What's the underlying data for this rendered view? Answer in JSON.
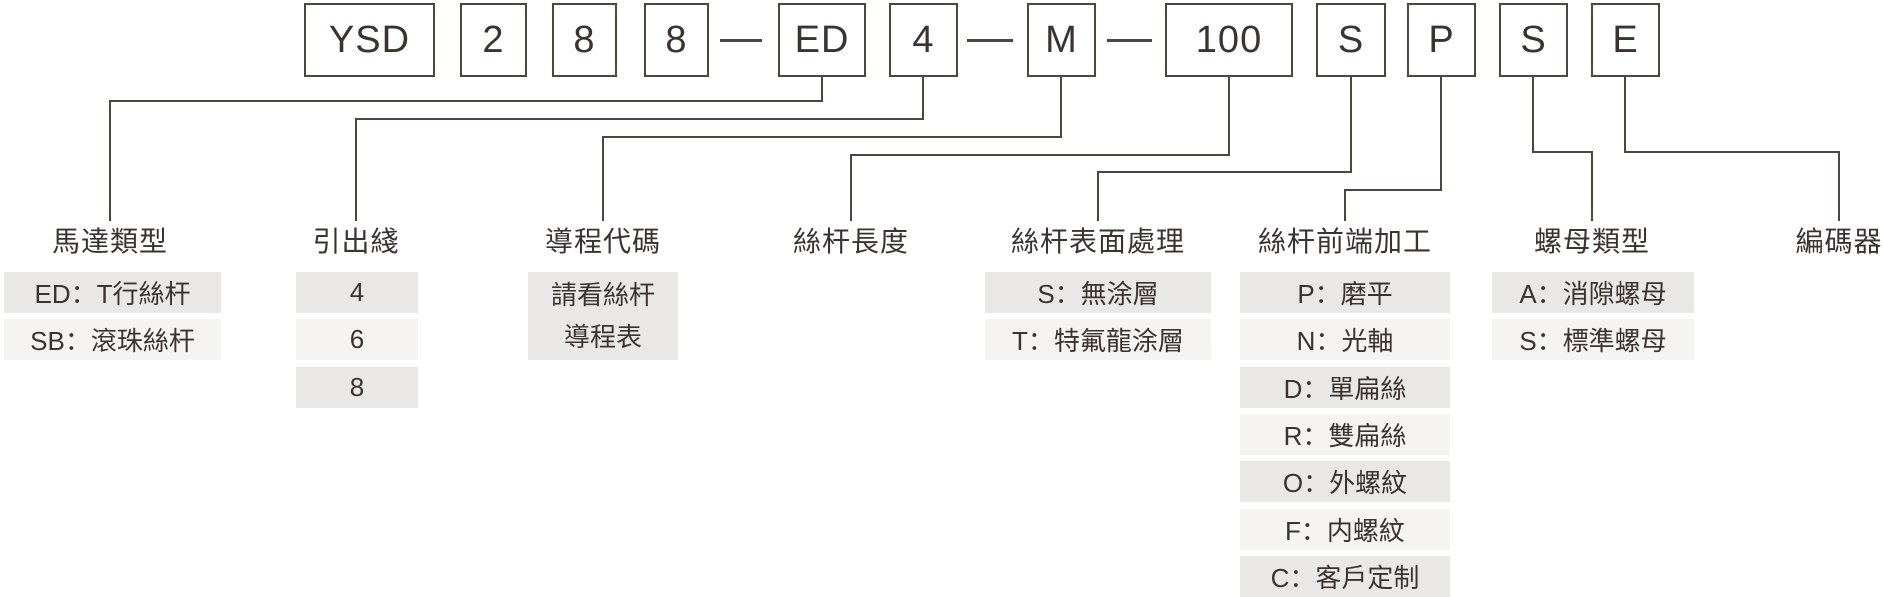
{
  "diagram": {
    "kind": "product-ordering-code-breakdown",
    "example_code": "YSD288-ED4-M-100SPSE"
  },
  "code_boxes": [
    {
      "text": "YSD",
      "x": 304,
      "w": 131
    },
    {
      "text": "2",
      "x": 460,
      "w": 67
    },
    {
      "text": "8",
      "x": 552,
      "w": 65
    },
    {
      "text": "8",
      "x": 644,
      "w": 65
    },
    {
      "text": "ED",
      "x": 778,
      "w": 88
    },
    {
      "text": "4",
      "x": 889,
      "w": 69
    },
    {
      "text": "M",
      "x": 1027,
      "w": 69
    },
    {
      "text": "100",
      "x": 1165,
      "w": 128
    },
    {
      "text": "S",
      "x": 1316,
      "w": 70
    },
    {
      "text": "P",
      "x": 1407,
      "w": 69
    },
    {
      "text": "S",
      "x": 1499,
      "w": 69
    },
    {
      "text": "E",
      "x": 1591,
      "w": 69
    }
  ],
  "dash_separators": [
    {
      "x": 720,
      "w": 42
    },
    {
      "x": 967,
      "w": 46
    },
    {
      "x": 1107,
      "w": 45
    }
  ],
  "columns": [
    {
      "label": "馬達類型",
      "cx": 110,
      "box_cx": 822,
      "elbow_y": 100,
      "items_x": 4,
      "items_w": 217,
      "items": [
        "ED：T行絲杆",
        "SB：滾珠絲杆"
      ]
    },
    {
      "label": "引出綫",
      "cx": 356,
      "box_cx": 923,
      "elbow_y": 118,
      "items_x": 296,
      "items_w": 122,
      "items": [
        "4",
        "6",
        "8"
      ]
    },
    {
      "label": "導程代碼",
      "cx": 603,
      "box_cx": 1061,
      "elbow_y": 136,
      "items_x": 528,
      "items_w": 150,
      "items": [],
      "note_lines": [
        "請看絲杆",
        "導程表"
      ]
    },
    {
      "label": "絲杆長度",
      "cx": 851,
      "box_cx": 1229,
      "elbow_y": 154,
      "items": []
    },
    {
      "label": "絲杆表面處理",
      "cx": 1098,
      "box_cx": 1351,
      "elbow_y": 171,
      "items_x": 985,
      "items_w": 226,
      "items": [
        "S：無涂層",
        "T：特氟龍涂層"
      ]
    },
    {
      "label": "絲杆前端加工",
      "cx": 1345,
      "box_cx": 1441,
      "elbow_y": 189,
      "items_x": 1240,
      "items_w": 210,
      "items": [
        "P：磨平",
        "N：光軸",
        "D：單扁絲",
        "R：雙扁絲",
        "O：外螺紋",
        "F：内螺紋",
        "C：客戶定制"
      ]
    },
    {
      "label": "螺母類型",
      "cx": 1592,
      "box_cx": 1533,
      "elbow_y": 151,
      "items_x": 1492,
      "items_w": 202,
      "items": [
        "A：消隙螺母",
        "S：標準螺母"
      ]
    },
    {
      "label": "編碼器",
      "cx": 1839,
      "box_cx": 1625,
      "elbow_y": 151,
      "items": []
    }
  ],
  "colors": {
    "line": "#4c4542",
    "text": "#3a3330",
    "row_dark": "#e9e8e7",
    "row_light": "#f5f4f3",
    "background": "#ffffff"
  }
}
